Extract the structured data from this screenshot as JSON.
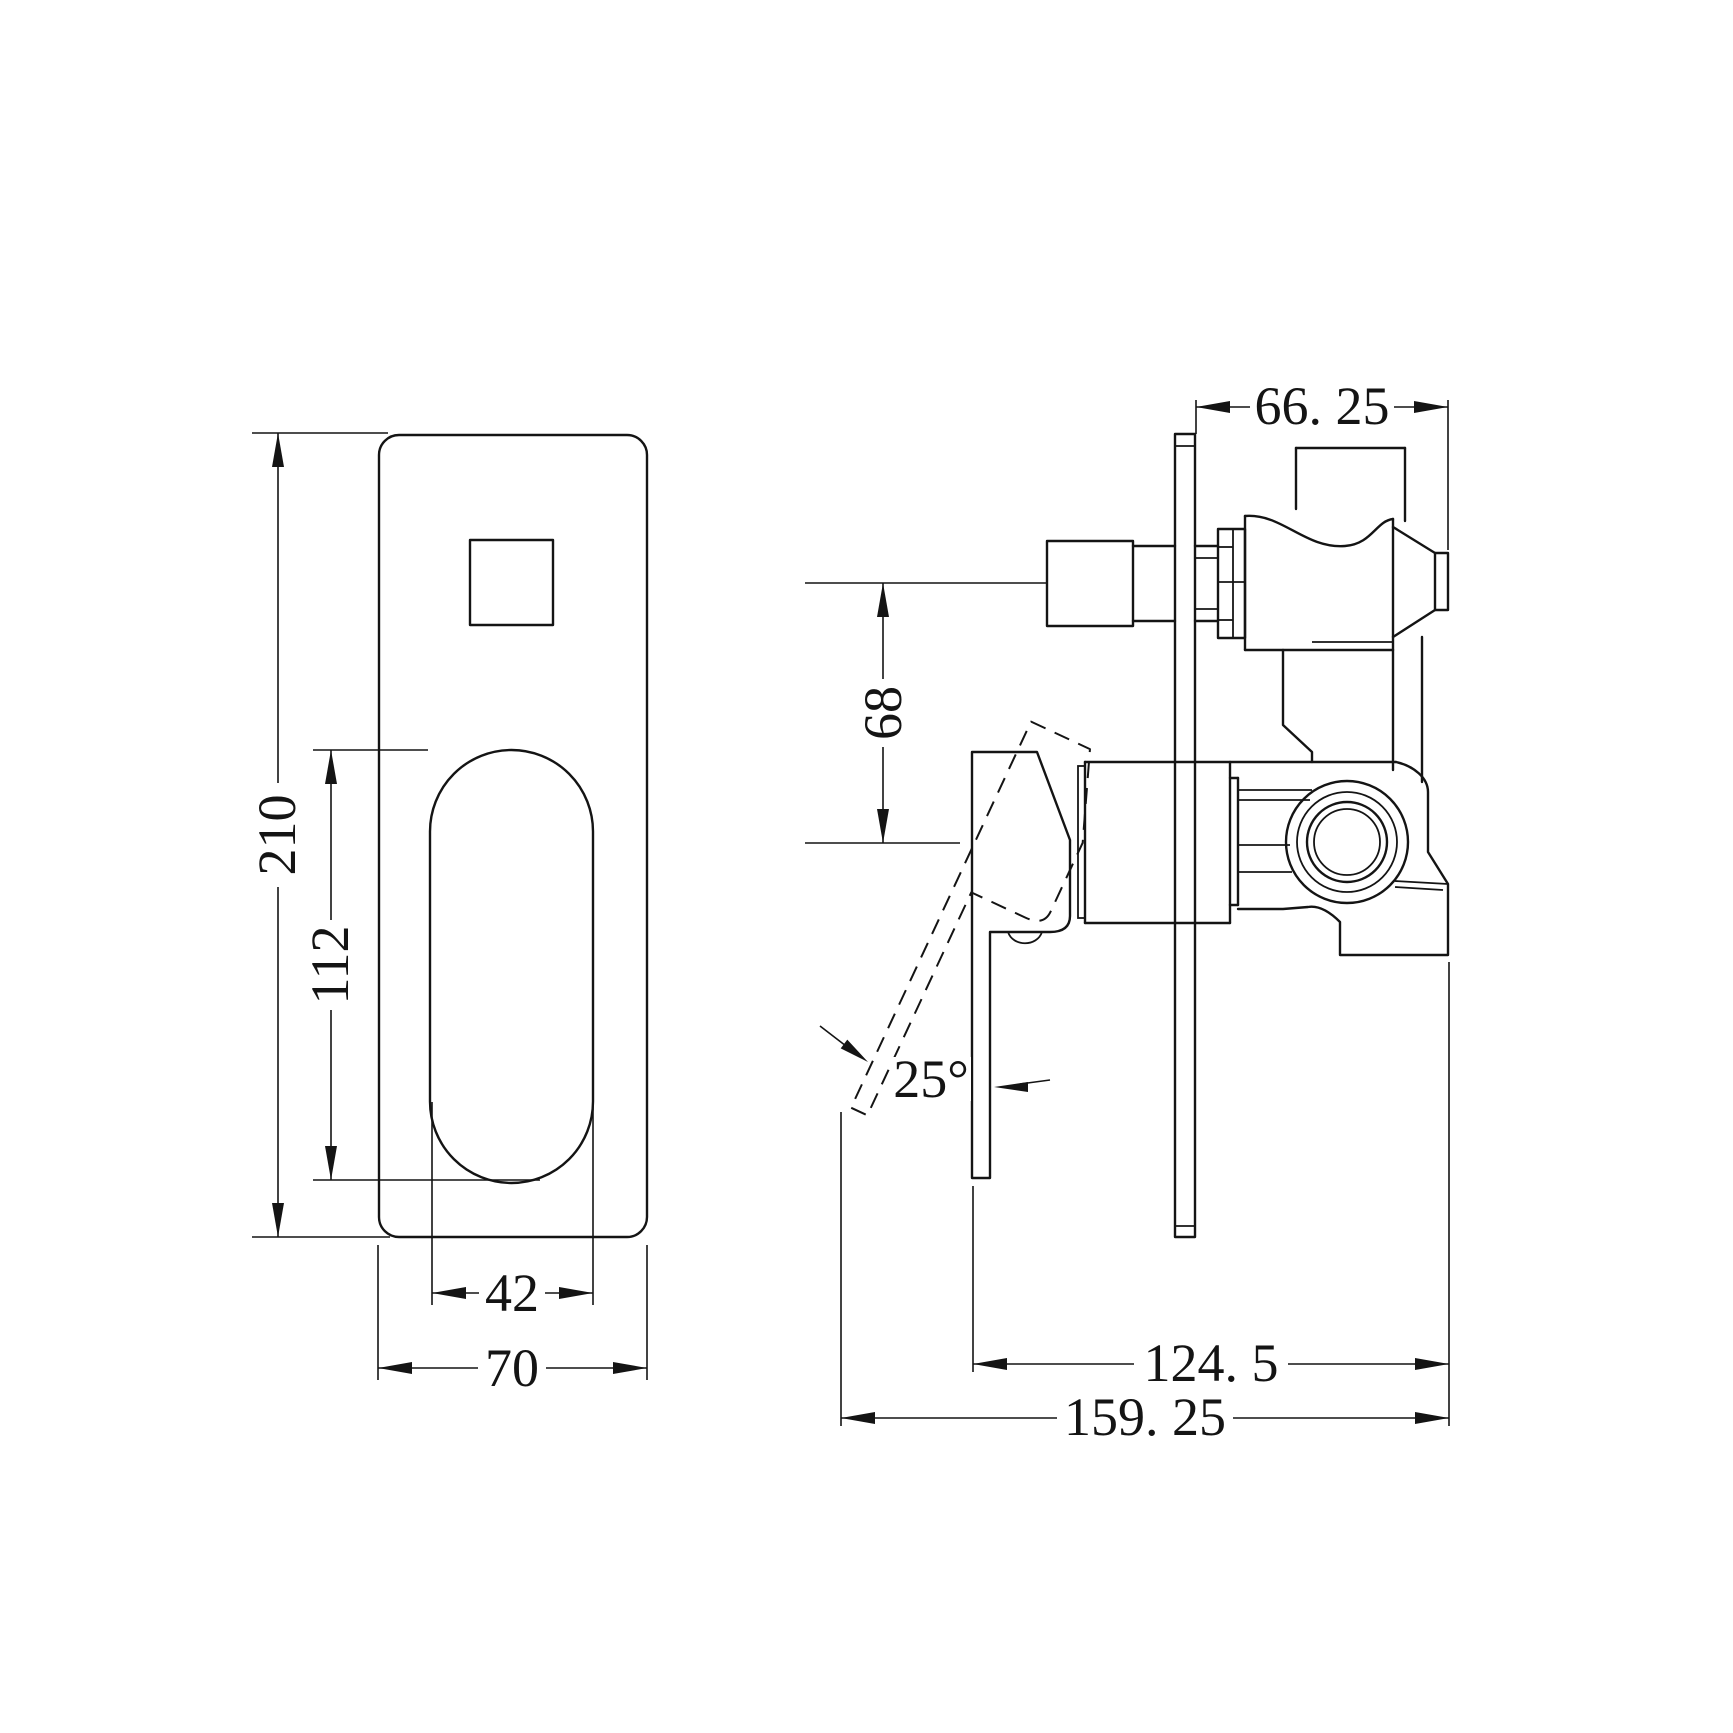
{
  "page": {
    "background": "#ffffff",
    "line_color": "#141414",
    "drawing_type": "shower mixer valve technical drawing, front and side orthographic views"
  },
  "dimensions": {
    "plate_height": {
      "label": "210"
    },
    "cutout_height": {
      "label": "112"
    },
    "cutout_width": {
      "label": "42"
    },
    "plate_width": {
      "label": "70"
    },
    "valve_front_depth": {
      "label": "66. 25"
    },
    "port_center_spacing": {
      "label": "68"
    },
    "handle_body_depth": {
      "label": "124. 5"
    },
    "total_depth": {
      "label": "159. 25"
    },
    "handle_swing_angle": {
      "label": "25°"
    }
  }
}
